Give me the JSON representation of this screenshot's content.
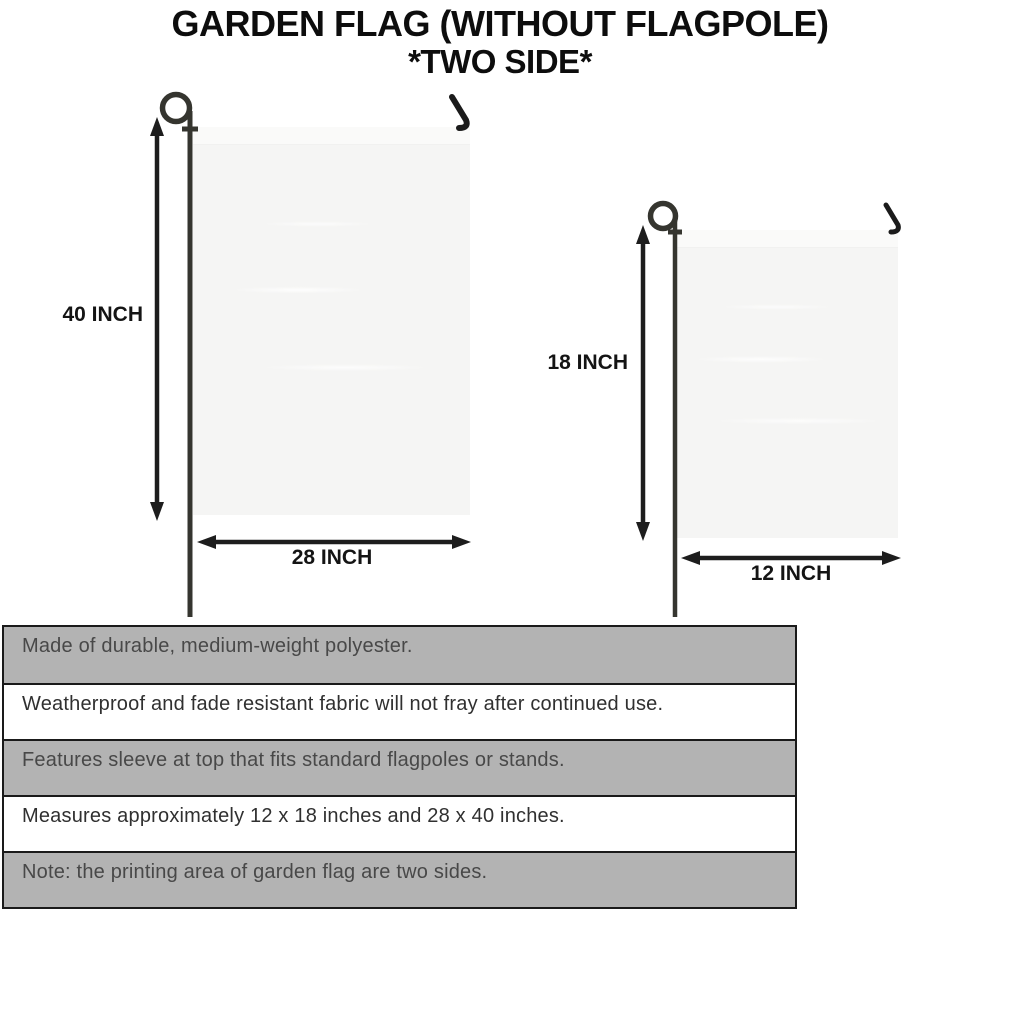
{
  "title": {
    "line1": "GARDEN FLAG (WITHOUT FLAGPOLE)",
    "line2": "*TWO SIDE*"
  },
  "diagram": {
    "large_flag": {
      "height_label": "40 INCH",
      "width_label": "28 INCH"
    },
    "small_flag": {
      "height_label": "18 INCH",
      "width_label": "12 INCH"
    }
  },
  "features": [
    {
      "text": "Made of durable, medium-weight polyester."
    },
    {
      "text": "Weatherproof and fade resistant fabric will not fray after continued use."
    },
    {
      "text": "Features sleeve at top that fits standard flagpoles or stands."
    },
    {
      "text": "Measures approximately 12 x 18 inches and 28 x 40 inches."
    },
    {
      "text": "Note: the printing area of garden flag are two sides."
    }
  ],
  "colors": {
    "shaded_row": "#b3b3b3",
    "table_border": "#1a1a1a",
    "flag_fabric": "#f5f5f4",
    "pole": "#35352f",
    "arrow": "#1d1d1d"
  }
}
